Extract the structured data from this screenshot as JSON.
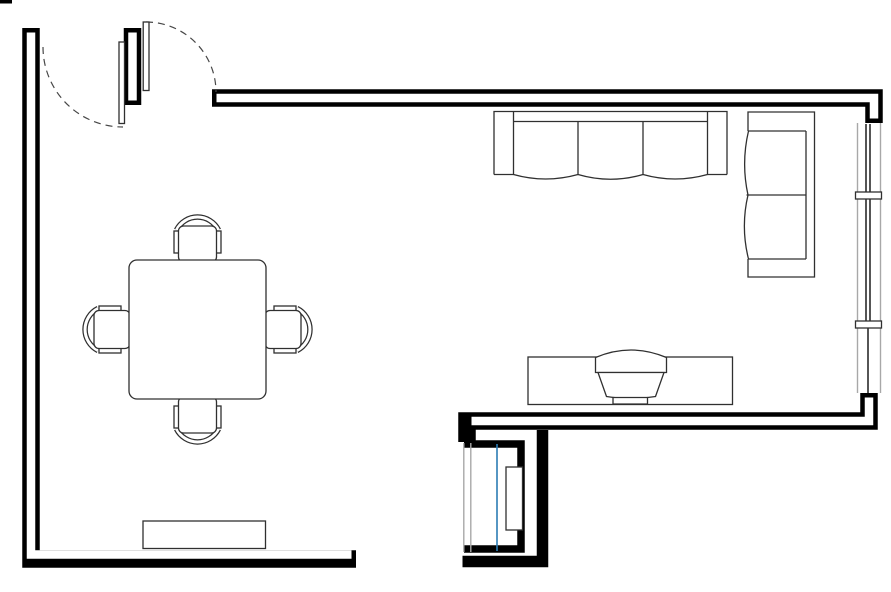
{
  "diagram": {
    "kind": "floor-plan",
    "room": "open-plan living and dining room",
    "visible_text": []
  },
  "colors": {
    "background": "#ffffff",
    "wall": "#000000",
    "furniture_stroke": "#303030",
    "window_frame": "#a8a8a8",
    "glass_blue": "#2b7cb4",
    "door_swing_dash": "#474747"
  },
  "structure": {
    "walls": [
      {
        "name": "left-and-bottom-left-wall",
        "style": "double-line hollow"
      },
      {
        "name": "top-wall",
        "style": "double-line hollow"
      },
      {
        "name": "living-room-bottom-wall",
        "style": "double-line hollow"
      },
      {
        "name": "door-pier",
        "style": "double-line hollow"
      },
      {
        "name": "closet-walls",
        "style": "solid"
      },
      {
        "name": "bottom-right-outer-wall",
        "style": "solid"
      }
    ],
    "openings": [
      {
        "name": "entry-double-door",
        "leaves": 2,
        "swing": "two dashed quarter-circle arcs"
      },
      {
        "name": "right-window",
        "sections": 3,
        "mullions": 2
      },
      {
        "name": "closet-window",
        "glazing": "blue line"
      }
    ]
  },
  "furniture": [
    {
      "name": "three-seat-sofa",
      "seats": 3,
      "against": "top wall"
    },
    {
      "name": "loveseat",
      "seats": 2,
      "against": "right wall"
    },
    {
      "name": "square-dining-table",
      "chairs": 4
    },
    {
      "name": "dining-chair",
      "count": 4,
      "parts": "curved backrest, two armrests, seat"
    },
    {
      "name": "tv-stand",
      "with": "crt-tv"
    },
    {
      "name": "sideboard",
      "against": "bottom-left wall"
    },
    {
      "name": "closet-cabinet"
    }
  ]
}
